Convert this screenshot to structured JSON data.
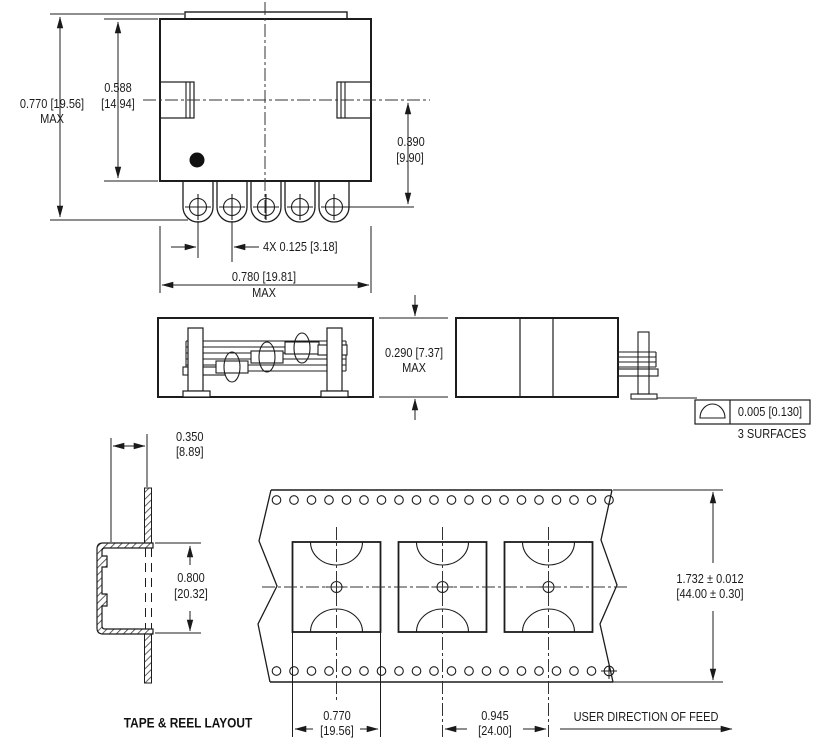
{
  "front_view": {
    "overall_height": "0.770 [19.56]",
    "overall_height_suffix": "MAX",
    "body_height": "0.588",
    "body_height_mm": "[14.94]",
    "lead_length": "0.390",
    "lead_length_mm": "[9.90]",
    "lead_pitch": "4X 0.125 [3.18]",
    "overall_width": "0.780 [19.81]",
    "overall_width_suffix": "MAX"
  },
  "side_view": {
    "height": "0.290 [7.37]",
    "height_suffix": "MAX"
  },
  "end_view": {
    "flatness_value": "0.005 [0.130]",
    "flatness_note": "3 SURFACES"
  },
  "pocket_section": {
    "depth": "0.350",
    "depth_mm": "[8.89]",
    "height": "0.800",
    "height_mm": "[20.32]"
  },
  "tape_layout": {
    "title": "TAPE & REEL LAYOUT",
    "tape_width": "1.732 ± 0.012",
    "tape_width_mm": "[44.00 ± 0.30]",
    "pocket_width": "0.770",
    "pocket_width_mm": "[19.56]",
    "pocket_pitch": "0.945",
    "pocket_pitch_mm": "[24.00]",
    "feed_note": "USER DIRECTION OF FEED"
  }
}
